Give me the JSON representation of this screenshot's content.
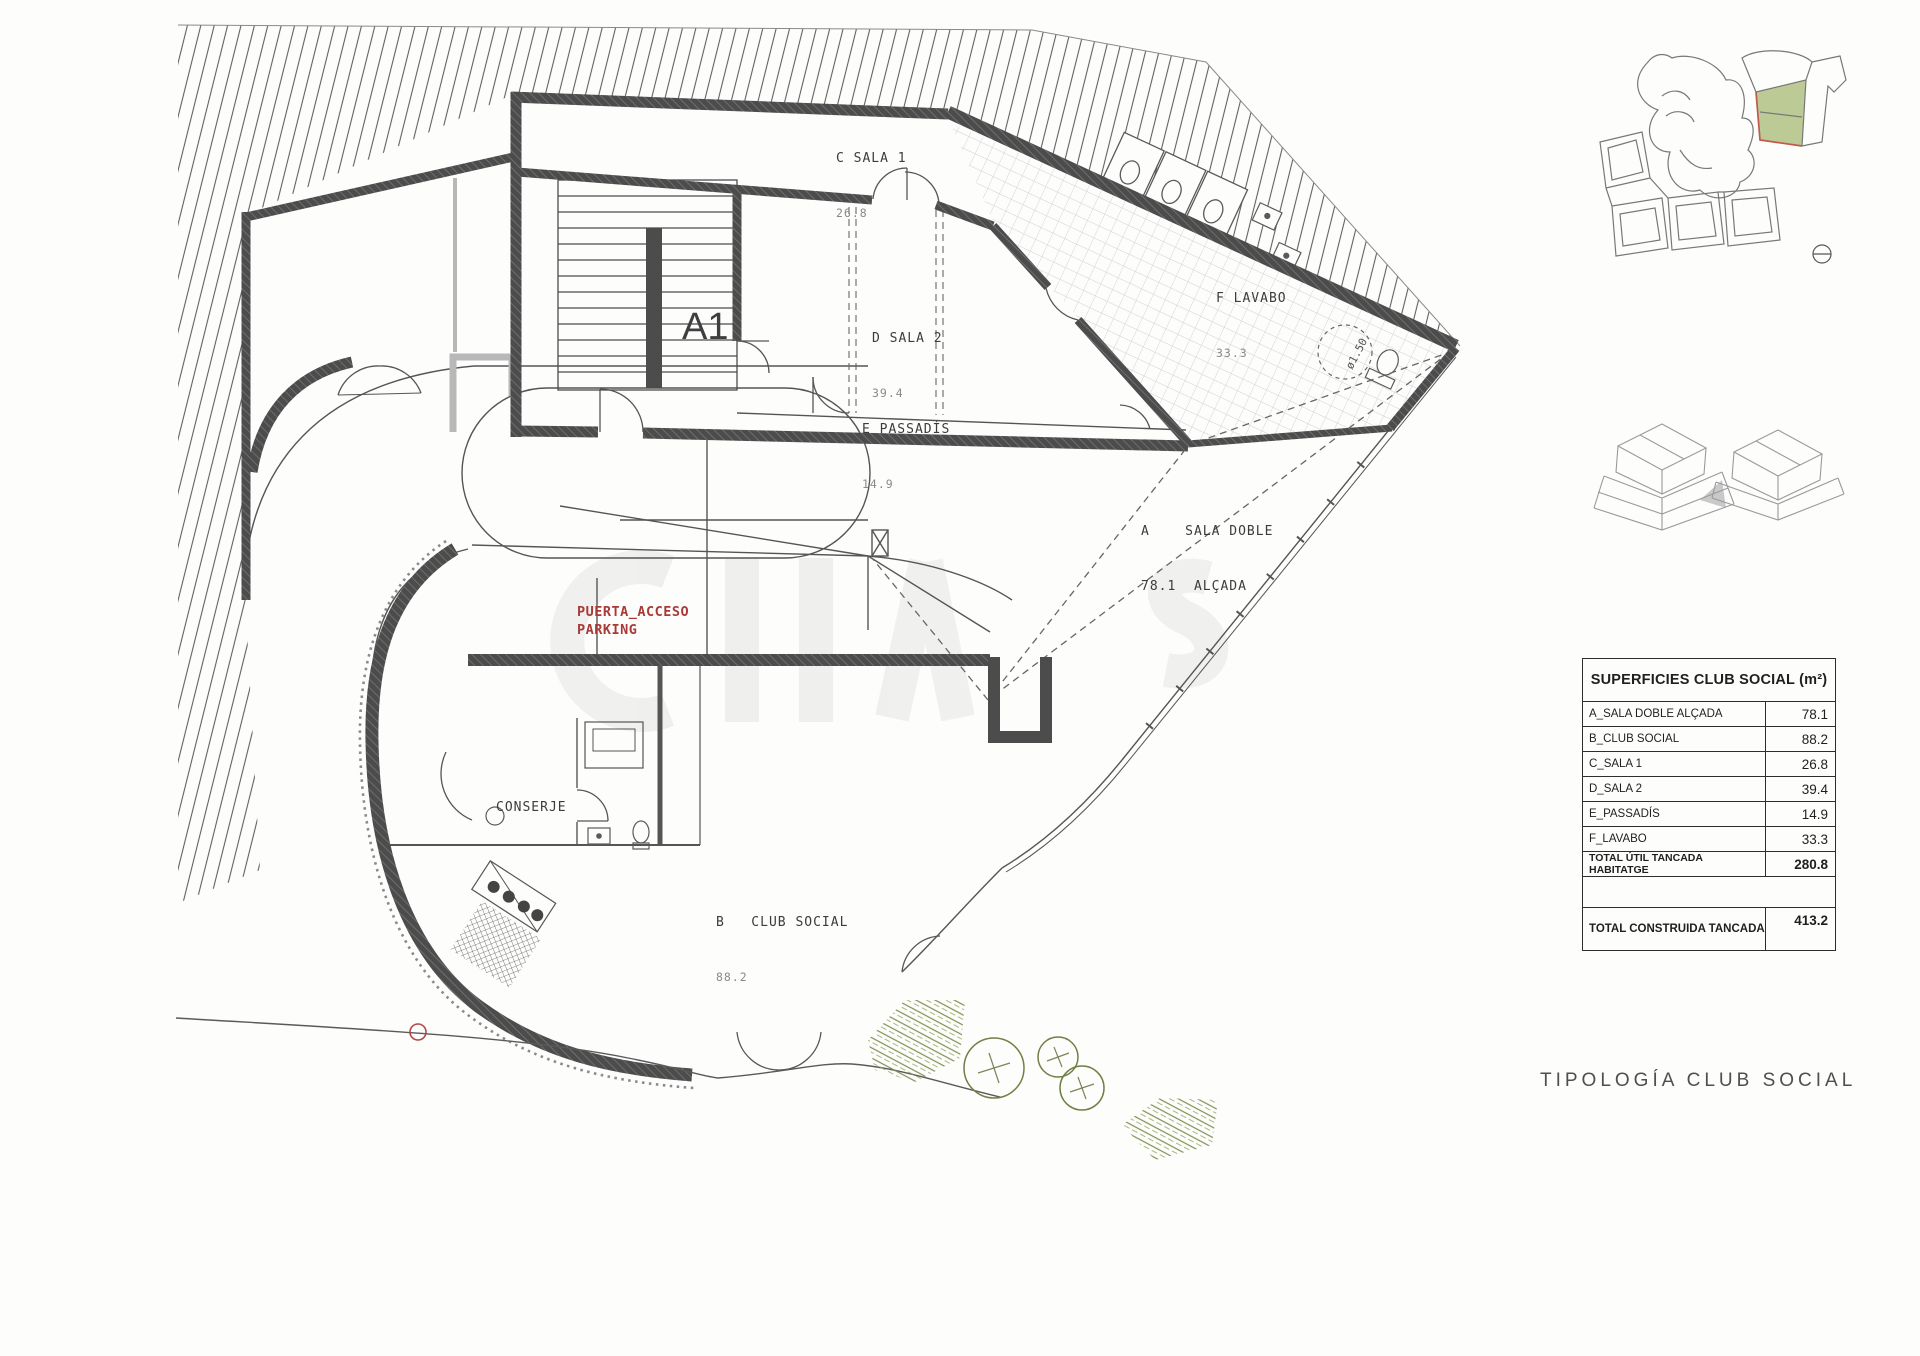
{
  "plan": {
    "rooms": {
      "c_sala_1": {
        "label": "C SALA 1",
        "area": "26.8"
      },
      "d_sala_2": {
        "label": "D SALA 2",
        "area": "39.4"
      },
      "e_passadis": {
        "label": "E PASSADÍS",
        "area": "14.9"
      },
      "f_lavabo": {
        "label": "F LAVABO",
        "area": "33.3"
      },
      "a_sala_doble": {
        "line1": "A    SALA DOBLE",
        "line2": "78.1  ALÇADA"
      },
      "b_club_social": {
        "line1": "B   CLUB SOCIAL",
        "line2": "88.2"
      },
      "conserje": {
        "label": "CONSERJE"
      }
    },
    "annotations": {
      "a1": "A1",
      "puerta_acceso_line1": "PUERTA_ACCESO",
      "puerta_acceso_line2": "PARKING",
      "shower_diameter": "ø1.50"
    }
  },
  "summary_table": {
    "title": "SUPERFICIES CLUB SOCIAL (m²)",
    "rows": [
      {
        "label": "A_SALA DOBLE ALÇADA",
        "value": "78.1"
      },
      {
        "label": "B_CLUB SOCIAL",
        "value": "88.2"
      },
      {
        "label": "C_SALA 1",
        "value": "26.8"
      },
      {
        "label": "D_SALA 2",
        "value": "39.4"
      },
      {
        "label": "E_PASSADÍS",
        "value": "14.9"
      },
      {
        "label": "F_LAVABO",
        "value": "33.3"
      },
      {
        "label": "TOTAL ÚTIL TANCADA HABITATGE",
        "value": "280.8"
      },
      {
        "label": "TOTAL CONSTRUIDA TANCADA",
        "value": "413.2"
      }
    ]
  },
  "title_block": {
    "typology": "TIPOLOGÍA CLUB SOCIAL"
  },
  "colors": {
    "wall": "#4c4c4c",
    "annotation_red": "#a93a38",
    "vegetation_green": "#7e904d",
    "parcel_green": "#bccb95",
    "parcel_red": "#c2574c"
  }
}
